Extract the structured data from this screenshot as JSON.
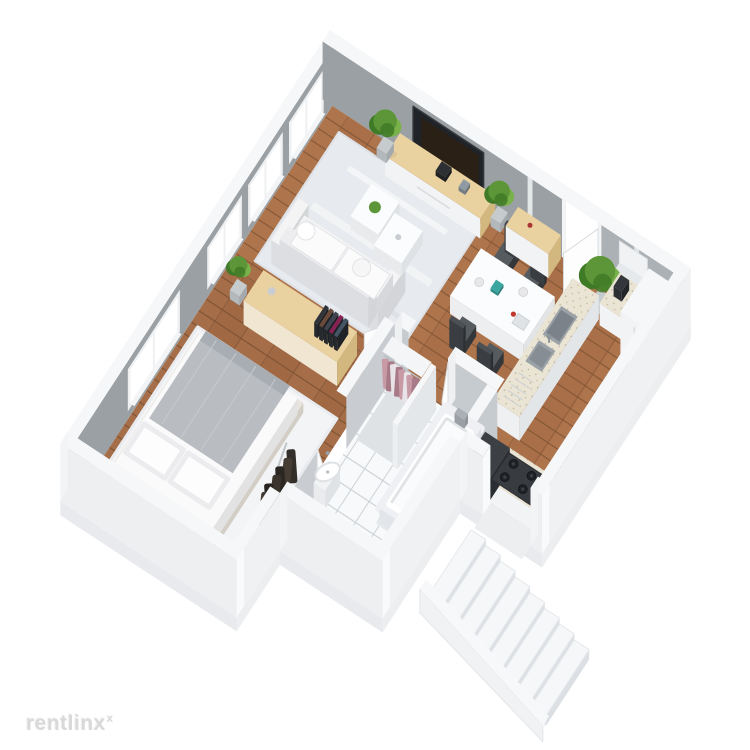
{
  "watermark": {
    "label": "rentlinx",
    "mark": "x"
  },
  "scene": {
    "kind": "3d-floor-plan-render",
    "view": "isometric-top"
  },
  "palette": {
    "background": "#ffffff",
    "wall_inner_dark": "#9aa0a4",
    "wall_inner_mid": "#abb1b5",
    "wall_inner_light": "#c6cbcf",
    "wall_top": "#f6f7f8",
    "wall_outer": "#edeff1",
    "wall_outer_side": "#e3e6e9",
    "slab": "#e8eaed",
    "wood_base": "#a96f48",
    "wood_dark": "#7e5233",
    "wood_light": "#b87e52",
    "rug_living": "#e7eaee",
    "rug_bedroom": "#f3f4f6",
    "tile_white": "#f8f9fa",
    "tile_line": "#ccd1d5",
    "counter_top": "#eae4d4",
    "counter_speckle": "#b9ae92",
    "cabinet_white": "#f2f3f4",
    "wood_furniture": "#ead1a0",
    "wood_furniture_side": "#d2b87f",
    "tv_black": "#202327",
    "sofa_white": "#f4f4f5",
    "sofa_shadow": "#dcdee1",
    "chair_dark": "#44484c",
    "table_white": "#fbfcfd",
    "plant_green": "#5d9638",
    "plant_green_dark": "#3f7a27",
    "plant_green_light": "#79b24a",
    "plant_pot": "#c6cbce",
    "clothes_pink": "#c79aa6",
    "clothes_pink_dark": "#a87987",
    "appliance_dark": "#33373b",
    "steel": "#9aa1a7",
    "stair_top": "#f6f7f9",
    "stair_riser": "#dce0e4",
    "glass_white": "#ffffff",
    "watermark_gray": "#d9d9d9"
  },
  "rooms": [
    {
      "id": "living-room",
      "items": [
        "area-rug",
        "sofa",
        "coffee-table-1",
        "coffee-table-2",
        "tv-console",
        "wall-tv",
        "plant-left",
        "plant-right"
      ]
    },
    {
      "id": "dining-area",
      "items": [
        "dining-table",
        "dining-chairs"
      ]
    },
    {
      "id": "entry",
      "items": [
        "entry-door",
        "shoe-cabinet",
        "plant-entry-large"
      ]
    },
    {
      "id": "kitchen",
      "items": [
        "sink-island",
        "kitchen-sink",
        "wall-counter",
        "knife-block",
        "wall-cabinet",
        "fridge-cabinet",
        "stove-counter",
        "gas-cooktop",
        "washing-machine",
        "cutting-board"
      ]
    },
    {
      "id": "bathroom",
      "items": [
        "tile-floor",
        "closet-clothes",
        "bathtub",
        "washbasin",
        "toilet"
      ]
    },
    {
      "id": "bedroom",
      "items": [
        "bedroom-rug",
        "double-bed",
        "pillows",
        "blanket",
        "nightstand",
        "plant-side-table",
        "bookshelf-sideboard",
        "plant-bedroom"
      ]
    },
    {
      "id": "hallway",
      "items": [
        "coat-rack",
        "boots",
        "shoe-bench"
      ]
    },
    {
      "id": "staircase",
      "items": [
        "steps",
        "stringer-wall"
      ]
    }
  ]
}
